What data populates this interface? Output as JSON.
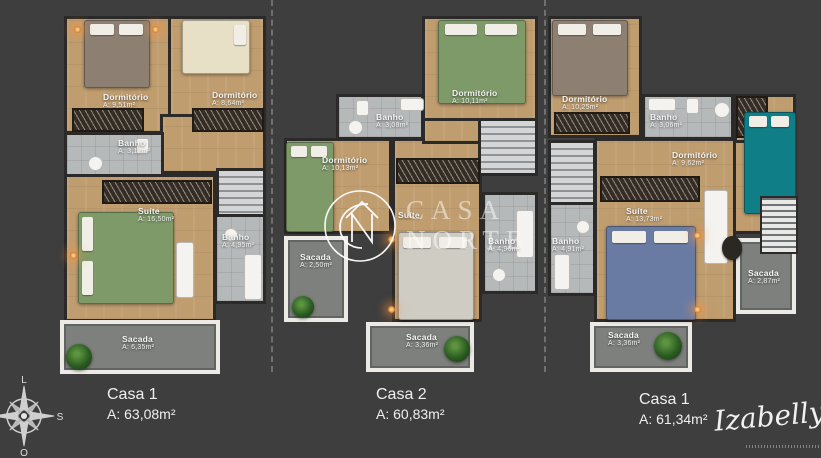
{
  "houses": [
    {
      "name": "Casa 1",
      "area_total": "A: 63,08m²",
      "rooms": [
        {
          "label": "Dormitório",
          "area": "A: 9,51m²"
        },
        {
          "label": "Dormitório",
          "area": "A: 8,64m²"
        },
        {
          "label": "Banho",
          "area": "A: 3,12m²"
        },
        {
          "label": "Suíte",
          "area": "A: 16,50m²"
        },
        {
          "label": "Banho",
          "area": "A: 4,95m²"
        },
        {
          "label": "Sacada",
          "area": "A: 6,35m²"
        }
      ]
    },
    {
      "name": "Casa 2",
      "area_total": "A: 60,83m²",
      "rooms": [
        {
          "label": "Dormitório",
          "area": "A: 10,11m²"
        },
        {
          "label": "Banho",
          "area": "A: 3,08m²"
        },
        {
          "label": "Dormitório",
          "area": "A: 10,13m²"
        },
        {
          "label": "Sacada",
          "area": "A: 2,50m²"
        },
        {
          "label": "Suíte",
          "area": ""
        },
        {
          "label": "Banho",
          "area": "A: 4,96m²"
        },
        {
          "label": "Sacada",
          "area": "A: 3,36m²"
        }
      ]
    },
    {
      "name": "Casa 1",
      "area_total": "A: 61,34m²",
      "rooms": [
        {
          "label": "Dormitório",
          "area": "A: 10,25m²"
        },
        {
          "label": "Banho",
          "area": "A: 3,06m²"
        },
        {
          "label": "Dormitório",
          "area": "A: 9,62m²"
        },
        {
          "label": "Suíte",
          "area": "A: 13,73m²"
        },
        {
          "label": "Banho",
          "area": "A: 4,91m²"
        },
        {
          "label": "Sacada",
          "area": "A: 2,87m²"
        },
        {
          "label": "Sacada",
          "area": "A: 3,36m²"
        }
      ]
    }
  ],
  "compass": {
    "top": "L",
    "right": "S",
    "bottom": "O"
  },
  "watermark": {
    "line1": "CASA",
    "line2": "NORTE"
  },
  "signature": {
    "name": "Izabelly"
  },
  "colors": {
    "background": "#3e3e3e",
    "wall": "#2b2a28",
    "wood_floor": "#bf9d6f",
    "bath_tile": "#b6b9ba",
    "balcony_floor": "#7d807c",
    "label_text": "#f5f5f5"
  }
}
